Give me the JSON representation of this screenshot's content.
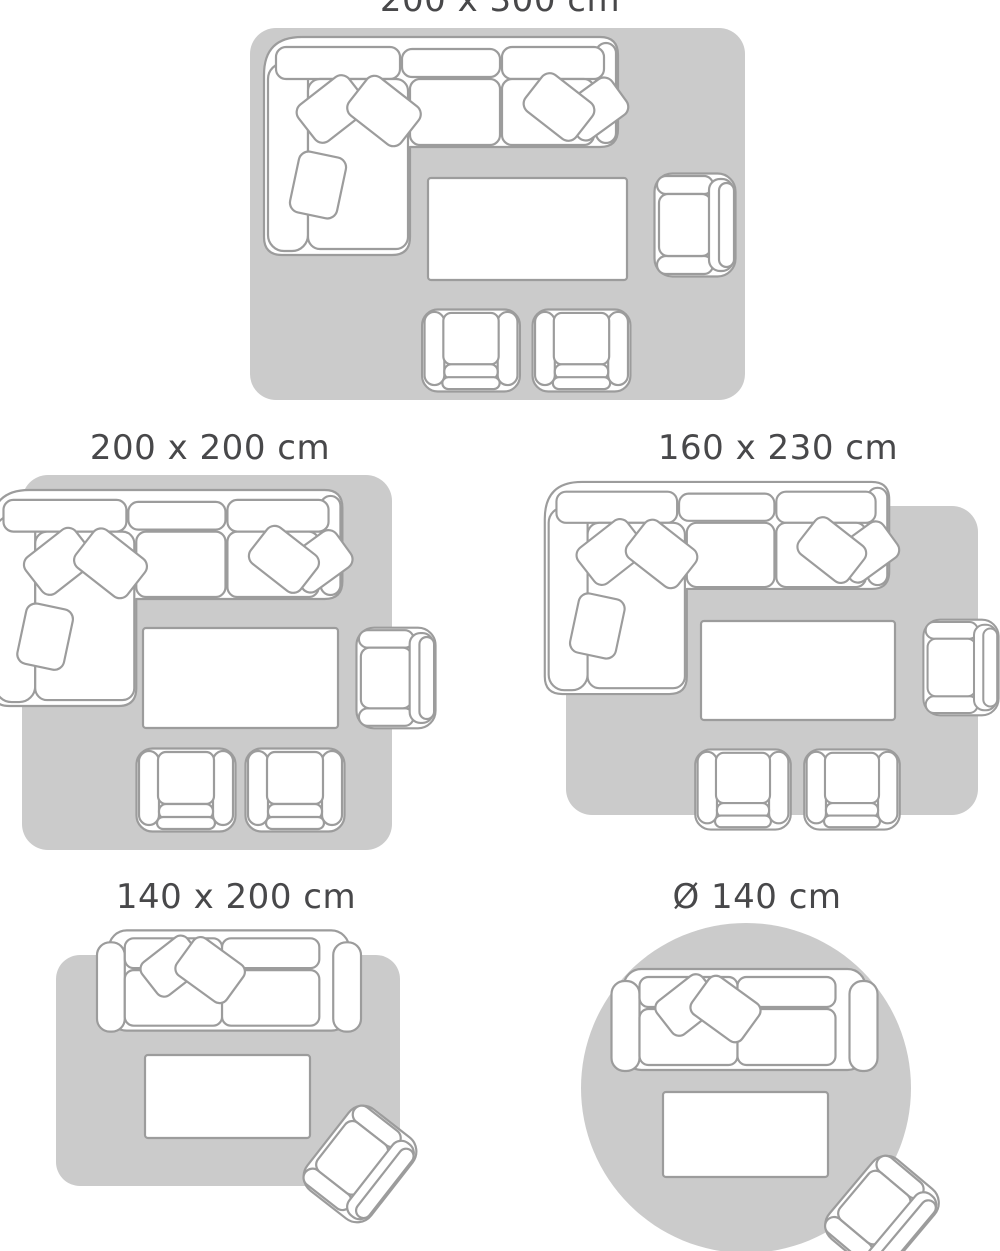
{
  "colors": {
    "background": "#ffffff",
    "rug_fill": "#cbcbcb",
    "furniture_fill": "#ffffff",
    "furniture_outline": "#9c9c9c",
    "label_text": "#48484a"
  },
  "size_guide": {
    "items": [
      {
        "label": "200 x 300 cm",
        "rug_shape": "rectangle",
        "furniture": [
          "corner-sofa",
          "coffee-table",
          "armchair",
          "chair",
          "chair"
        ]
      },
      {
        "label": "200 x 200 cm",
        "rug_shape": "square",
        "furniture": [
          "corner-sofa",
          "coffee-table",
          "armchair",
          "chair",
          "chair"
        ]
      },
      {
        "label": "160 x 230 cm",
        "rug_shape": "rectangle",
        "furniture": [
          "corner-sofa",
          "coffee-table",
          "armchair",
          "chair",
          "chair"
        ]
      },
      {
        "label": "140 x 200 cm",
        "rug_shape": "rectangle",
        "furniture": [
          "loveseat-sofa",
          "coffee-table",
          "armchair-rotated"
        ]
      },
      {
        "label": "Ø 140 cm",
        "rug_shape": "circle",
        "furniture": [
          "loveseat-sofa",
          "coffee-table",
          "armchair-rotated"
        ]
      }
    ]
  }
}
